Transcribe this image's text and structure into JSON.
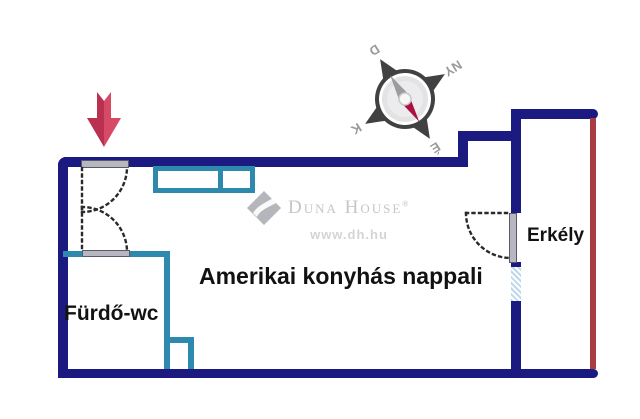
{
  "floorplan": {
    "rooms": {
      "living": {
        "label": "Amerikai konyhás nappali"
      },
      "bathroom": {
        "label": "Fürdő-wc"
      },
      "balcony": {
        "label": "Erkély"
      }
    },
    "compass": {
      "north": "É",
      "south": "D",
      "east": "K",
      "west": "NY",
      "rotation_deg": 148
    },
    "colors": {
      "outer_wall": "#1a1a80",
      "interior_wall": "#2e89ae",
      "balcony_railing": "#a93c42",
      "entrance_arrow": "#cd3b59",
      "door_leaf": "#b7b7c2",
      "window_fill": "#bcd9eb",
      "room_text": "#121212",
      "watermark_gray": "#c5c5ca"
    }
  },
  "watermark": {
    "brand": "Duna House",
    "registered": "®",
    "url": "www.dh.hu"
  }
}
